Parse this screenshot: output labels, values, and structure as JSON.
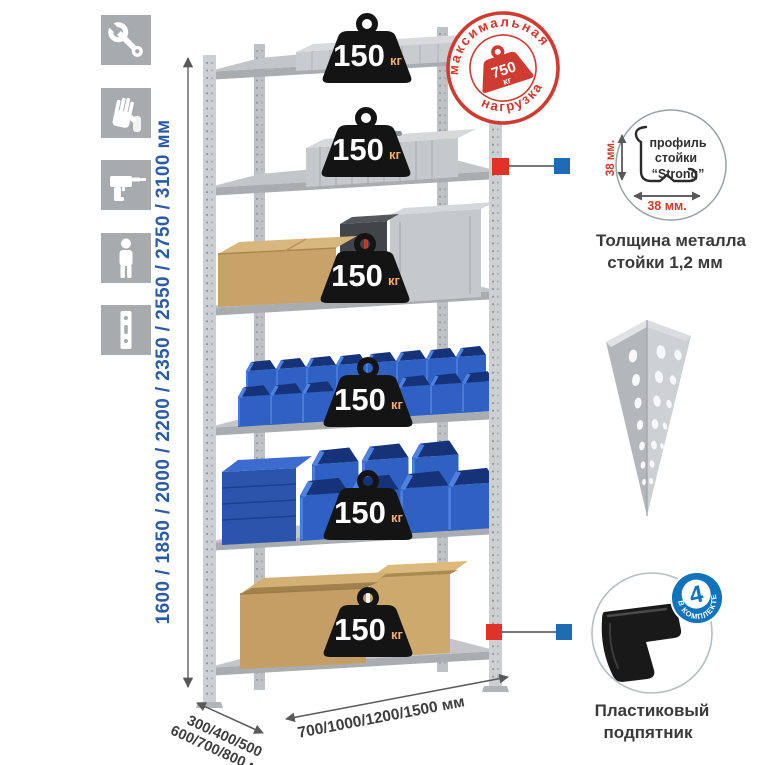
{
  "sidebar_icons": [
    {
      "name": "wrench"
    },
    {
      "name": "gloves"
    },
    {
      "name": "drill"
    },
    {
      "name": "person"
    },
    {
      "name": "rack-upright"
    }
  ],
  "dimensions": {
    "height": {
      "label": "1600 / 1850 / 2000 / 2200 / 2350 / 2550 / 2750 / 3100 мм"
    },
    "depth": {
      "line1": "300/400/500",
      "line2": "600/700/800 мм"
    },
    "width": {
      "label": "700/1000/1200/1500 мм"
    }
  },
  "shelf_load": {
    "value": "150",
    "unit": "кг",
    "badge_count": 6
  },
  "max_load": {
    "arc_top": "максимальная",
    "arc_bottom": "нагрузка",
    "value": "750",
    "unit": "кг"
  },
  "post_profile": {
    "label_line1": "профиль",
    "label_line2": "стойки",
    "label_line3": "“Strong”",
    "vertical_dim": "38 мм.",
    "horizontal_dim": "38 мм.",
    "caption_line1": "Толщина металла",
    "caption_line2": "стойки 1,2 мм"
  },
  "foot": {
    "caption_line1": "Пластиковый",
    "caption_line2": "подпятник",
    "badge_value": "4",
    "badge_caption": "в комплекте"
  },
  "colors": {
    "accent_red": "#cf3b31",
    "marker_red": "#e23128",
    "marker_blue": "#1f6cb5",
    "dim_text_blue": "#2b5aa7",
    "badge_black": "#141414"
  }
}
